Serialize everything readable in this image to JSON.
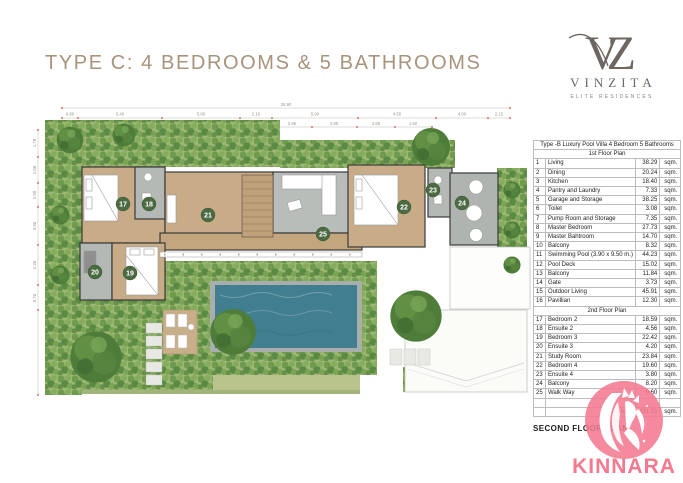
{
  "header": {
    "title": "TYPE C: 4 BEDROOMS & 5 BATHROOMS"
  },
  "brand": {
    "monogram": "VZ",
    "name": "VINZITA",
    "tagline": "ELITE RESIDENCES"
  },
  "floor_plan": {
    "label": "SECOND FLOOR PLAN",
    "dim_total": "26.90",
    "dims_top": [
      "0.80",
      "5.40",
      "5.00",
      "2.10",
      "5.90",
      "4.50",
      "4.00",
      "2.15"
    ],
    "dims_sub": [
      "2.95",
      "2.95",
      "2.65",
      "1.60"
    ],
    "dims_left": [
      "1.78",
      "1.08",
      "1.50",
      "3.50",
      "2.20",
      "0.70"
    ],
    "badges": [
      "17",
      "18",
      "19",
      "20",
      "21",
      "22",
      "23",
      "24",
      "25"
    ]
  },
  "table": {
    "title": "Type -B Luxury Pool Villa 4 Bedroom 5 Bathrooms",
    "rows": [
      {
        "section": "1st Floor Plan"
      },
      {
        "n": "1",
        "name": "Living",
        "area": "38.29",
        "unit": "sqm."
      },
      {
        "n": "2",
        "name": "Dining",
        "area": "20.24",
        "unit": "sqm."
      },
      {
        "n": "3",
        "name": "Kitchen",
        "area": "18.40",
        "unit": "sqm."
      },
      {
        "n": "4",
        "name": "Pantry and Laundry",
        "area": "7.33",
        "unit": "sqm."
      },
      {
        "n": "5",
        "name": "Garage and Storage",
        "area": "38.25",
        "unit": "sqm."
      },
      {
        "n": "6",
        "name": "Toilet",
        "area": "3.08",
        "unit": "sqm."
      },
      {
        "n": "7",
        "name": "Pump Room and Storage",
        "area": "7.35",
        "unit": "sqm."
      },
      {
        "n": "8",
        "name": "Master Bedroom",
        "area": "27.73",
        "unit": "sqm."
      },
      {
        "n": "9",
        "name": "Master Bahtroom",
        "area": "14.70",
        "unit": "sqm."
      },
      {
        "n": "10",
        "name": "Balcony",
        "area": "8.32",
        "unit": "sqm."
      },
      {
        "n": "11",
        "name": "Swimming Pool (3.90 x 9.50 m.)",
        "area": "44.23",
        "unit": "sqm."
      },
      {
        "n": "12",
        "name": "Pool Deck",
        "area": "15.02",
        "unit": "sqm."
      },
      {
        "n": "13",
        "name": "Balcony",
        "area": "11.84",
        "unit": "sqm."
      },
      {
        "n": "14",
        "name": "Gate",
        "area": "3.73",
        "unit": "sqm."
      },
      {
        "n": "15",
        "name": "Outdoor Living",
        "area": "45.91",
        "unit": "sqm."
      },
      {
        "n": "16",
        "name": "Pavillian",
        "area": "12.30",
        "unit": "sqm."
      },
      {
        "section": "2nd Floor Plan"
      },
      {
        "n": "17",
        "name": "Bedroom 2",
        "area": "18.59",
        "unit": "sqm."
      },
      {
        "n": "18",
        "name": "Ensuite 2",
        "area": "4.56",
        "unit": "sqm."
      },
      {
        "n": "19",
        "name": "Bedroom 3",
        "area": "22.42",
        "unit": "sqm."
      },
      {
        "n": "20",
        "name": "Ensuite 3",
        "area": "4.20",
        "unit": "sqm."
      },
      {
        "n": "21",
        "name": "Study Room",
        "area": "23.84",
        "unit": "sqm."
      },
      {
        "n": "22",
        "name": "Bedroom 4",
        "area": "19.60",
        "unit": "sqm."
      },
      {
        "n": "23",
        "name": "Ensuite 4",
        "area": "3.80",
        "unit": "sqm."
      },
      {
        "n": "24",
        "name": "Balcony",
        "area": "8.20",
        "unit": "sqm."
      },
      {
        "n": "25",
        "name": "Walk Way",
        "area": "9.60",
        "unit": "sqm."
      },
      {
        "blank": true
      },
      {
        "total": true,
        "n": "",
        "name": "Total Area",
        "area": "431.53",
        "unit": "sqm."
      }
    ]
  },
  "watermark": {
    "name": "KINNARA"
  },
  "colors": {
    "accent_tan": "#a8937d",
    "brand_gray": "#6e6660",
    "pink": "#f4798f",
    "pool": "#417f90",
    "badge_green": "#4c6b43",
    "wood": "#c8ac88",
    "tile": "#b9bdb9",
    "grass": "#b9c48d"
  }
}
